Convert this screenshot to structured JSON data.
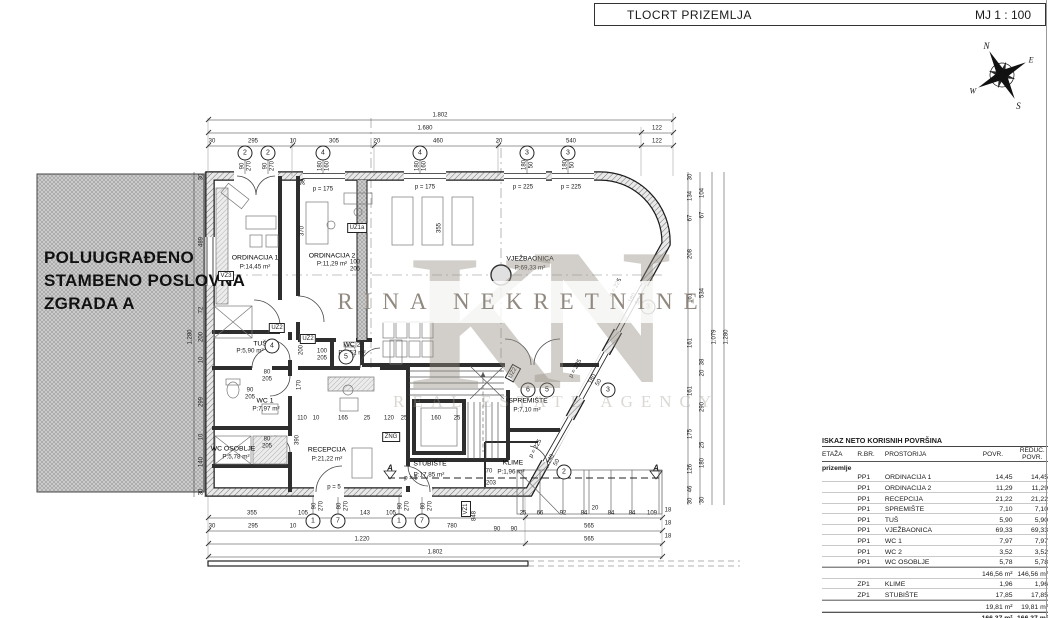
{
  "header": {
    "title": "TLOCRT PRIZEMLJA",
    "scale": "MJ 1 : 100"
  },
  "compass": {
    "n": "N",
    "e": "E",
    "s": "S",
    "w": "W"
  },
  "adjacent_building": {
    "line1": "POLUUGRAĐENO",
    "line2": "STAMBENO POSLOVNA",
    "line3": "ZGRADA A"
  },
  "watermark": {
    "k": "K",
    "n": "N",
    "name": "RINA NEKRETNINE",
    "tagline": "REAL ESTATE AGENCY"
  },
  "colors": {
    "wall": "#1c1c1c",
    "dim": "#333333",
    "hatch_fill": "#d2d2d2",
    "watermark": "#948c81"
  },
  "rooms": [
    {
      "name": "ORDINACIJA 1",
      "area": "P:14,45 m²"
    },
    {
      "name": "ORDINACIJA 2",
      "area": "P:11,29 m²"
    },
    {
      "name": "VJEŽBAONICA",
      "area": "P:69,33 m²"
    },
    {
      "name": "RECEPCIJA",
      "area": "P:21,22 m²"
    },
    {
      "name": "SPREMIŠTE",
      "area": "P:7,10 m²"
    },
    {
      "name": "STUBIŠTE",
      "area": "P:17,85 m²"
    },
    {
      "name": "TUŠ",
      "area": "P:5,90 m²"
    },
    {
      "name": "WC 1",
      "area": "P:7,97 m²"
    },
    {
      "name": "WC 2",
      "area": "P:3,52 m²"
    },
    {
      "name": "WC OSOBLJE",
      "area": "P:5,78 m²"
    },
    {
      "name": "KLIME",
      "area": "P:1,96 m²"
    }
  ],
  "plan": {
    "labels": [
      {
        "t": "1.802",
        "x": 440,
        "y": 116,
        "c": "d"
      },
      {
        "t": "1.680",
        "x": 425,
        "y": 129,
        "c": "d"
      },
      {
        "t": "122",
        "x": 657,
        "y": 129,
        "c": "d"
      },
      {
        "t": "30",
        "x": 212,
        "y": 142,
        "c": "d"
      },
      {
        "t": "295",
        "x": 253,
        "y": 142,
        "c": "d"
      },
      {
        "t": "10",
        "x": 293,
        "y": 142,
        "c": "d"
      },
      {
        "t": "305",
        "x": 334,
        "y": 142,
        "c": "d"
      },
      {
        "t": "20",
        "x": 377,
        "y": 142,
        "c": "d"
      },
      {
        "t": "460",
        "x": 438,
        "y": 142,
        "c": "d"
      },
      {
        "t": "20",
        "x": 499,
        "y": 142,
        "c": "d"
      },
      {
        "t": "540",
        "x": 571,
        "y": 142,
        "c": "d"
      },
      {
        "t": "122",
        "x": 657,
        "y": 142,
        "c": "d"
      },
      {
        "t": "355",
        "x": 252,
        "y": 514,
        "c": "d"
      },
      {
        "t": "105",
        "x": 303,
        "y": 514,
        "c": "d"
      },
      {
        "t": "143",
        "x": 365,
        "y": 514,
        "c": "d"
      },
      {
        "t": "105",
        "x": 391,
        "y": 514,
        "c": "d"
      },
      {
        "t": "25",
        "x": 523,
        "y": 514,
        "c": "d"
      },
      {
        "t": "66",
        "x": 540,
        "y": 514,
        "c": "d"
      },
      {
        "t": "92",
        "x": 563,
        "y": 514,
        "c": "d"
      },
      {
        "t": "84",
        "x": 584,
        "y": 514,
        "c": "d"
      },
      {
        "t": "20",
        "x": 595,
        "y": 509,
        "c": "d"
      },
      {
        "t": "84",
        "x": 611,
        "y": 514,
        "c": "d"
      },
      {
        "t": "84",
        "x": 632,
        "y": 514,
        "c": "d"
      },
      {
        "t": "109",
        "x": 652,
        "y": 514,
        "c": "d"
      },
      {
        "t": "18",
        "x": 668,
        "y": 511,
        "c": "d"
      },
      {
        "t": "30",
        "x": 212,
        "y": 527,
        "c": "d"
      },
      {
        "t": "295",
        "x": 253,
        "y": 527,
        "c": "d"
      },
      {
        "t": "10",
        "x": 293,
        "y": 527,
        "c": "d"
      },
      {
        "t": "780",
        "x": 452,
        "y": 527,
        "c": "d"
      },
      {
        "t": "90",
        "x": 497,
        "y": 530,
        "c": "d"
      },
      {
        "t": "90",
        "x": 514,
        "y": 530,
        "c": "d"
      },
      {
        "t": "565",
        "x": 589,
        "y": 527,
        "c": "d"
      },
      {
        "t": "18",
        "x": 668,
        "y": 524,
        "c": "d"
      },
      {
        "t": "1.220",
        "x": 362,
        "y": 540,
        "c": "d"
      },
      {
        "t": "565",
        "x": 589,
        "y": 540,
        "c": "d"
      },
      {
        "t": "18",
        "x": 668,
        "y": 537,
        "c": "d"
      },
      {
        "t": "1.802",
        "x": 435,
        "y": 553,
        "c": "d"
      },
      {
        "t": "848",
        "x": 475,
        "y": 516,
        "c": "d",
        "r": -90
      },
      {
        "t": "30",
        "x": 691,
        "y": 177,
        "c": "d",
        "r": -90
      },
      {
        "t": "134",
        "x": 691,
        "y": 196,
        "c": "d",
        "r": -90
      },
      {
        "t": "67",
        "x": 691,
        "y": 218,
        "c": "d",
        "r": -90
      },
      {
        "t": "208",
        "x": 691,
        "y": 254,
        "c": "d",
        "r": -90
      },
      {
        "t": "161",
        "x": 691,
        "y": 298,
        "c": "d",
        "r": -90
      },
      {
        "t": "161",
        "x": 691,
        "y": 343,
        "c": "d",
        "r": -90
      },
      {
        "t": "161",
        "x": 691,
        "y": 391,
        "c": "d",
        "r": -90
      },
      {
        "t": "175",
        "x": 691,
        "y": 434,
        "c": "d",
        "r": -90
      },
      {
        "t": "126",
        "x": 691,
        "y": 469,
        "c": "d",
        "r": -90
      },
      {
        "t": "46",
        "x": 691,
        "y": 489,
        "c": "d",
        "r": -90
      },
      {
        "t": "30",
        "x": 691,
        "y": 501,
        "c": "d",
        "r": -90
      },
      {
        "t": "104",
        "x": 703,
        "y": 193,
        "c": "d",
        "r": -90
      },
      {
        "t": "67",
        "x": 703,
        "y": 215,
        "c": "d",
        "r": -90
      },
      {
        "t": "534",
        "x": 703,
        "y": 293,
        "c": "d",
        "r": -90
      },
      {
        "t": "38",
        "x": 703,
        "y": 362,
        "c": "d",
        "r": -90
      },
      {
        "t": "20",
        "x": 703,
        "y": 373,
        "c": "d",
        "r": -90
      },
      {
        "t": "290",
        "x": 703,
        "y": 407,
        "c": "d",
        "r": -90
      },
      {
        "t": "25",
        "x": 703,
        "y": 445,
        "c": "d",
        "r": -90
      },
      {
        "t": "180",
        "x": 703,
        "y": 463,
        "c": "d",
        "r": -90
      },
      {
        "t": "30",
        "x": 703,
        "y": 500,
        "c": "d",
        "r": -90
      },
      {
        "t": "1.079",
        "x": 715,
        "y": 337,
        "c": "d",
        "r": -90
      },
      {
        "t": "1.280",
        "x": 727,
        "y": 337,
        "c": "d",
        "r": -90
      },
      {
        "t": "30",
        "x": 202,
        "y": 177,
        "c": "d",
        "r": -90
      },
      {
        "t": "489",
        "x": 202,
        "y": 242,
        "c": "d",
        "r": -90
      },
      {
        "t": "72",
        "x": 202,
        "y": 310,
        "c": "d",
        "r": -90
      },
      {
        "t": "200",
        "x": 202,
        "y": 337,
        "c": "d",
        "r": -90
      },
      {
        "t": "10",
        "x": 202,
        "y": 360,
        "c": "d",
        "r": -90
      },
      {
        "t": "299",
        "x": 202,
        "y": 402,
        "c": "d",
        "r": -90
      },
      {
        "t": "10",
        "x": 202,
        "y": 437,
        "c": "d",
        "r": -90
      },
      {
        "t": "140",
        "x": 202,
        "y": 462,
        "c": "d",
        "r": -90
      },
      {
        "t": "30",
        "x": 202,
        "y": 492,
        "c": "d",
        "r": -90
      },
      {
        "t": "1.280",
        "x": 191,
        "y": 337,
        "c": "d",
        "r": -90
      },
      {
        "t": "370",
        "x": 303,
        "y": 231,
        "c": "d",
        "r": -90
      },
      {
        "t": "355",
        "x": 440,
        "y": 228,
        "c": "d",
        "r": -90
      },
      {
        "t": "170",
        "x": 300,
        "y": 385,
        "c": "d",
        "r": -90
      },
      {
        "t": "200",
        "x": 302,
        "y": 350,
        "c": "d",
        "r": -90
      },
      {
        "t": "390",
        "x": 298,
        "y": 440,
        "c": "d",
        "r": -90
      },
      {
        "t": "30",
        "x": 304,
        "y": 182,
        "c": "d",
        "r": -90
      },
      {
        "t": "110",
        "x": 302,
        "y": 419,
        "c": "d"
      },
      {
        "t": "10",
        "x": 316,
        "y": 419,
        "c": "d"
      },
      {
        "t": "165",
        "x": 343,
        "y": 419,
        "c": "d"
      },
      {
        "t": "25",
        "x": 367,
        "y": 419,
        "c": "d"
      },
      {
        "t": "120",
        "x": 389,
        "y": 419,
        "c": "d"
      },
      {
        "t": "25",
        "x": 404,
        "y": 419,
        "c": "d"
      },
      {
        "t": "160",
        "x": 436,
        "y": 419,
        "c": "d"
      },
      {
        "t": "25",
        "x": 457,
        "y": 419,
        "c": "d"
      },
      {
        "t": "70",
        "x": 489,
        "y": 472,
        "c": "d"
      },
      {
        "t": "203",
        "x": 491,
        "y": 484,
        "c": "d"
      },
      {
        "t": "90\n270",
        "x": 246,
        "y": 166,
        "c": "d",
        "r": -90
      },
      {
        "t": "90\n270",
        "x": 269,
        "y": 166,
        "c": "d",
        "r": -90
      },
      {
        "t": "180\n160",
        "x": 324,
        "y": 166,
        "c": "d",
        "r": -90
      },
      {
        "t": "180\n160",
        "x": 421,
        "y": 166,
        "c": "d",
        "r": -90
      },
      {
        "t": "180\n50",
        "x": 528,
        "y": 165,
        "c": "d",
        "r": -90
      },
      {
        "t": "180\n50",
        "x": 569,
        "y": 165,
        "c": "d",
        "r": -90
      },
      {
        "t": "90\n270",
        "x": 318,
        "y": 506,
        "c": "d",
        "r": -90
      },
      {
        "t": "80\n270",
        "x": 343,
        "y": 506,
        "c": "d",
        "r": -90
      },
      {
        "t": "90\n270",
        "x": 404,
        "y": 506,
        "c": "d",
        "r": -90
      },
      {
        "t": "80\n270",
        "x": 427,
        "y": 506,
        "c": "d",
        "r": -90
      },
      {
        "t": "180\n50",
        "x": 636,
        "y": 300,
        "c": "d",
        "r": -61
      },
      {
        "t": "180\n50",
        "x": 596,
        "y": 381,
        "c": "d",
        "r": -61
      },
      {
        "t": "140\n50",
        "x": 554,
        "y": 461,
        "c": "d",
        "r": -61
      },
      {
        "t": "p = 175",
        "x": 323,
        "y": 190,
        "c": "p"
      },
      {
        "t": "p = 175",
        "x": 425,
        "y": 188,
        "c": "p"
      },
      {
        "t": "p = 225",
        "x": 523,
        "y": 188,
        "c": "p"
      },
      {
        "t": "p = 225",
        "x": 571,
        "y": 188,
        "c": "p"
      },
      {
        "t": "p = 225",
        "x": 616,
        "y": 288,
        "c": "p",
        "r": -61
      },
      {
        "t": "p = 225",
        "x": 576,
        "y": 369,
        "c": "p",
        "r": -61
      },
      {
        "t": "p = 225",
        "x": 536,
        "y": 449,
        "c": "p",
        "r": -61
      },
      {
        "t": "p = 5",
        "x": 334,
        "y": 488,
        "c": "p"
      },
      {
        "t": "p = 5",
        "x": 411,
        "y": 479,
        "c": "p"
      },
      {
        "t": "100\n205",
        "x": 355,
        "y": 266,
        "c": "d"
      },
      {
        "t": "100\n205",
        "x": 322,
        "y": 355,
        "c": "d"
      },
      {
        "t": "80\n205",
        "x": 267,
        "y": 376,
        "c": "d"
      },
      {
        "t": "90\n205",
        "x": 250,
        "y": 394,
        "c": "d"
      },
      {
        "t": "80\n205",
        "x": 267,
        "y": 443,
        "c": "d"
      },
      {
        "t": "A",
        "x": 390,
        "y": 469,
        "c": "a"
      },
      {
        "t": "A",
        "x": 656,
        "y": 469,
        "c": "a"
      },
      {
        "t": "ORDINACIJA 1",
        "x": 255,
        "y": 258,
        "c": "room"
      },
      {
        "t": "P:14,45 m²",
        "x": 255,
        "y": 268,
        "c": "area"
      },
      {
        "t": "ORDINACIJA 2",
        "x": 332,
        "y": 256,
        "c": "room"
      },
      {
        "t": "P:11,29 m²",
        "x": 332,
        "y": 265,
        "c": "area"
      },
      {
        "t": "VJEŽBAONICA",
        "x": 530,
        "y": 259,
        "c": "room"
      },
      {
        "t": "P:69,33 m²",
        "x": 530,
        "y": 269,
        "c": "area"
      },
      {
        "t": "RECEPCIJA",
        "x": 327,
        "y": 450,
        "c": "room"
      },
      {
        "t": "P:21,22 m²",
        "x": 327,
        "y": 460,
        "c": "area"
      },
      {
        "t": "SPREMIŠTE",
        "x": 528,
        "y": 401,
        "c": "room"
      },
      {
        "t": "P:7,10 m²",
        "x": 527,
        "y": 411,
        "c": "area"
      },
      {
        "t": "STUBIŠTE",
        "x": 430,
        "y": 464,
        "c": "room"
      },
      {
        "t": "P:17,85 m²",
        "x": 429,
        "y": 476,
        "c": "area"
      },
      {
        "t": "TUŠ",
        "x": 260,
        "y": 344,
        "c": "room"
      },
      {
        "t": "P:5,90 m²",
        "x": 250,
        "y": 352,
        "c": "area"
      },
      {
        "t": "WC 1",
        "x": 265,
        "y": 401,
        "c": "room"
      },
      {
        "t": "P:7,97 m²",
        "x": 266,
        "y": 410,
        "c": "area"
      },
      {
        "t": "WC 2",
        "x": 352,
        "y": 345,
        "c": "room"
      },
      {
        "t": "P:3,52 m²",
        "x": 352,
        "y": 354,
        "c": "area"
      },
      {
        "t": "WC OSOBLJE",
        "x": 233,
        "y": 449,
        "c": "room"
      },
      {
        "t": "P:5,78 m²",
        "x": 236,
        "y": 458,
        "c": "area"
      },
      {
        "t": "KLIME",
        "x": 513,
        "y": 463,
        "c": "room"
      },
      {
        "t": "P:1,96 m²",
        "x": 511,
        "y": 473,
        "c": "area"
      },
      {
        "t": "VZ3",
        "x": 226,
        "y": 276,
        "c": "tag"
      },
      {
        "t": "UZ1a",
        "x": 357,
        "y": 228,
        "c": "tag"
      },
      {
        "t": "UZ2",
        "x": 277,
        "y": 328,
        "c": "tag"
      },
      {
        "t": "UZ2",
        "x": 308,
        "y": 339,
        "c": "tag"
      },
      {
        "t": "UZ2",
        "x": 513,
        "y": 373,
        "c": "tag",
        "r": -61
      },
      {
        "t": "ZNG",
        "x": 391,
        "y": 437,
        "c": "tag"
      },
      {
        "t": "VZ1",
        "x": 466,
        "y": 509,
        "c": "tag",
        "r": -90
      },
      {
        "t": "2",
        "x": 245,
        "y": 153,
        "c": "bub"
      },
      {
        "t": "2",
        "x": 268,
        "y": 153,
        "c": "bub"
      },
      {
        "t": "4",
        "x": 323,
        "y": 153,
        "c": "bub"
      },
      {
        "t": "4",
        "x": 420,
        "y": 153,
        "c": "bub"
      },
      {
        "t": "3",
        "x": 527,
        "y": 153,
        "c": "bub"
      },
      {
        "t": "3",
        "x": 568,
        "y": 153,
        "c": "bub"
      },
      {
        "t": "1",
        "x": 313,
        "y": 521,
        "c": "bub"
      },
      {
        "t": "7",
        "x": 338,
        "y": 521,
        "c": "bub"
      },
      {
        "t": "1",
        "x": 399,
        "y": 521,
        "c": "bub"
      },
      {
        "t": "7",
        "x": 422,
        "y": 521,
        "c": "bub"
      },
      {
        "t": "3",
        "x": 648,
        "y": 307,
        "c": "bub"
      },
      {
        "t": "3",
        "x": 608,
        "y": 390,
        "c": "bub"
      },
      {
        "t": "2",
        "x": 564,
        "y": 472,
        "c": "bub"
      },
      {
        "t": "6",
        "x": 528,
        "y": 390,
        "c": "bub"
      },
      {
        "t": "5",
        "x": 547,
        "y": 390,
        "c": "bub"
      },
      {
        "t": "4",
        "x": 272,
        "y": 346,
        "c": "bub"
      },
      {
        "t": "5",
        "x": 346,
        "y": 357,
        "c": "bub"
      }
    ]
  },
  "table": {
    "title": "ISKAZ NETO KORISNIH POVRŠINA",
    "headers": {
      "etaza": "ETAŽA",
      "rbr": "R.BR.",
      "prostorija": "PROSTORIJA",
      "povr": "POVR.",
      "reduc": "REDUC.\nPOVR."
    },
    "group": "prizemlje",
    "rows": [
      {
        "rbr": "PP1",
        "name": "ORDINACIJA 1",
        "povr": "14,45",
        "reduc": "14,45",
        "type": "item"
      },
      {
        "rbr": "PP1",
        "name": "ORDINACIJA 2",
        "povr": "11,29",
        "reduc": "11,29",
        "type": "item"
      },
      {
        "rbr": "PP1",
        "name": "RECEPCIJA",
        "povr": "21,22",
        "reduc": "21,22",
        "type": "item"
      },
      {
        "rbr": "PP1",
        "name": "SPREMIŠTE",
        "povr": "7,10",
        "reduc": "7,10",
        "type": "item"
      },
      {
        "rbr": "PP1",
        "name": "TUŠ",
        "povr": "5,90",
        "reduc": "5,90",
        "type": "item"
      },
      {
        "rbr": "PP1",
        "name": "VJEŽBAONICA",
        "povr": "69,33",
        "reduc": "69,33",
        "type": "item"
      },
      {
        "rbr": "PP1",
        "name": "WC 1",
        "povr": "7,97",
        "reduc": "7,97",
        "type": "item"
      },
      {
        "rbr": "PP1",
        "name": "WC 2",
        "povr": "3,52",
        "reduc": "3,52",
        "type": "item"
      },
      {
        "rbr": "PP1",
        "name": "WC OSOBLJE",
        "povr": "5,78",
        "reduc": "5,78",
        "type": "item"
      },
      {
        "rbr": "",
        "name": "",
        "povr": "146,56 m²",
        "reduc": "146,56 m²",
        "type": "sub"
      },
      {
        "rbr": "ZP1",
        "name": "KLIME",
        "povr": "1,96",
        "reduc": "1,96",
        "type": "item"
      },
      {
        "rbr": "ZP1",
        "name": "STUBIŠTE",
        "povr": "17,85",
        "reduc": "17,85",
        "type": "item"
      },
      {
        "rbr": "",
        "name": "",
        "povr": "19,81 m²",
        "reduc": "19,81 m²",
        "type": "sub"
      },
      {
        "rbr": "",
        "name": "",
        "povr": "166,37 m²",
        "reduc": "166,37 m²",
        "type": "total"
      }
    ]
  }
}
